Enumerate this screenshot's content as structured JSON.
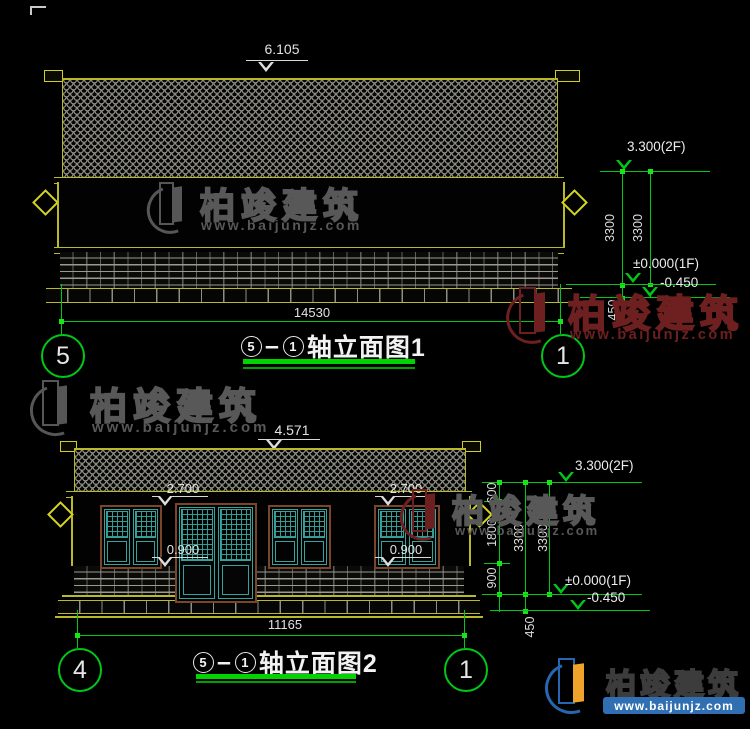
{
  "brand": {
    "name": "柏竣建筑",
    "site": "www.baijunjz.com"
  },
  "views": {
    "v1": {
      "ridge": "6.105",
      "width": "14530",
      "axis_left": "5",
      "axis_right": "1",
      "title_axis_a": "5",
      "title_dash": "–",
      "title_axis_b": "1",
      "title": "轴立面图1",
      "lv2f": "3.300(2F)",
      "lv1f": "±0.000(1F)",
      "lvminus": "-0.450",
      "d3300a": "3300",
      "d3300b": "3300",
      "d450": "450"
    },
    "v2": {
      "ridge": "4.571",
      "width": "11165",
      "axis_left": "4",
      "axis_right": "1",
      "title_axis_a": "5",
      "title_dash": "–",
      "title_axis_b": "1",
      "title": "轴立面图2",
      "head": "2.700",
      "sill": "0.900",
      "lv2f": "3.300(2F)",
      "lv1f": "±0.000(1F)",
      "lvminus": "-0.450",
      "d600": "600",
      "d1800": "1800",
      "d900": "900",
      "d3300a": "3300",
      "d3300b": "3300",
      "d450": "450"
    }
  }
}
